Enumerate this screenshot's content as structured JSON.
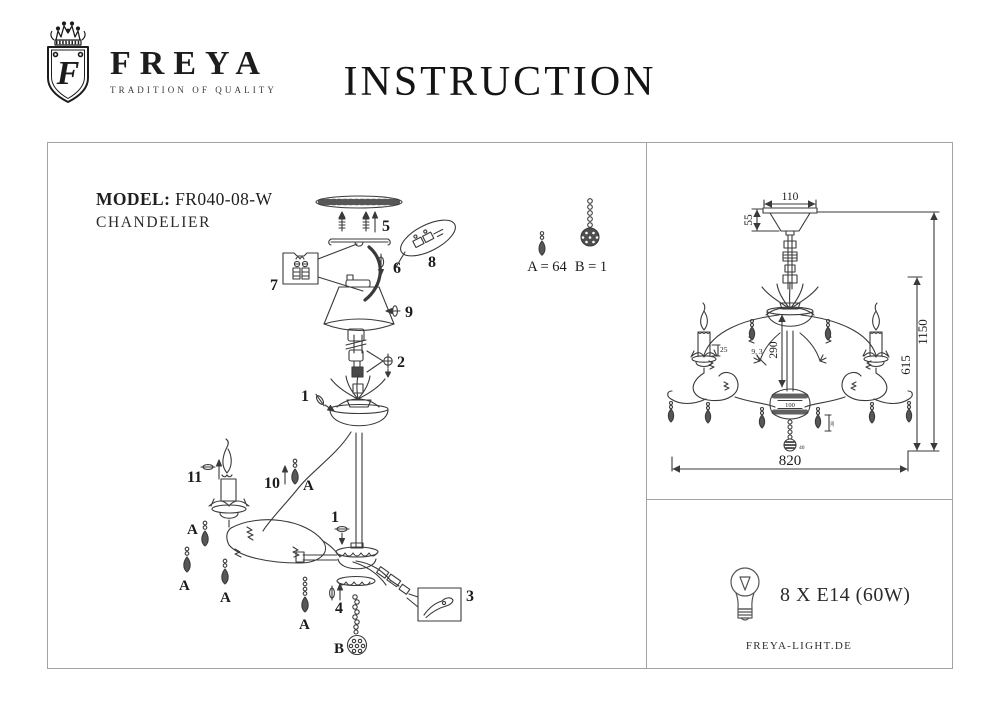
{
  "header": {
    "brand": "FREYA",
    "brand_initial": "F",
    "tagline": "TRADITION OF QUALITY",
    "title": "INSTRUCTION"
  },
  "model": {
    "label": "MODEL:",
    "value": "FR040-08-W",
    "type": "CHANDELIER"
  },
  "exploded": {
    "callouts": {
      "c1": "1",
      "c2": "2",
      "c3": "3",
      "c4": "4",
      "c5": "5",
      "c6": "6",
      "c7": "7",
      "c8": "8",
      "c9": "9",
      "c10": "10",
      "c11": "11"
    },
    "crystal_a": "A",
    "crystal_b": "B",
    "count_a": "A = 64",
    "count_b": "B = 1"
  },
  "dimensions": {
    "canopy_width": "110",
    "canopy_height": "55",
    "stem_length": "290",
    "arm_drop_height": "615",
    "total_height": "1150",
    "total_width": "820",
    "candle_sleeve": "25",
    "branch_detail": "9, 3",
    "body_diameter": "100",
    "pendant_height": "38",
    "ball_diameter": "40"
  },
  "spec": {
    "bulbs": "8 X E14 (60W)",
    "website": "FREYA-LIGHT.DE"
  }
}
